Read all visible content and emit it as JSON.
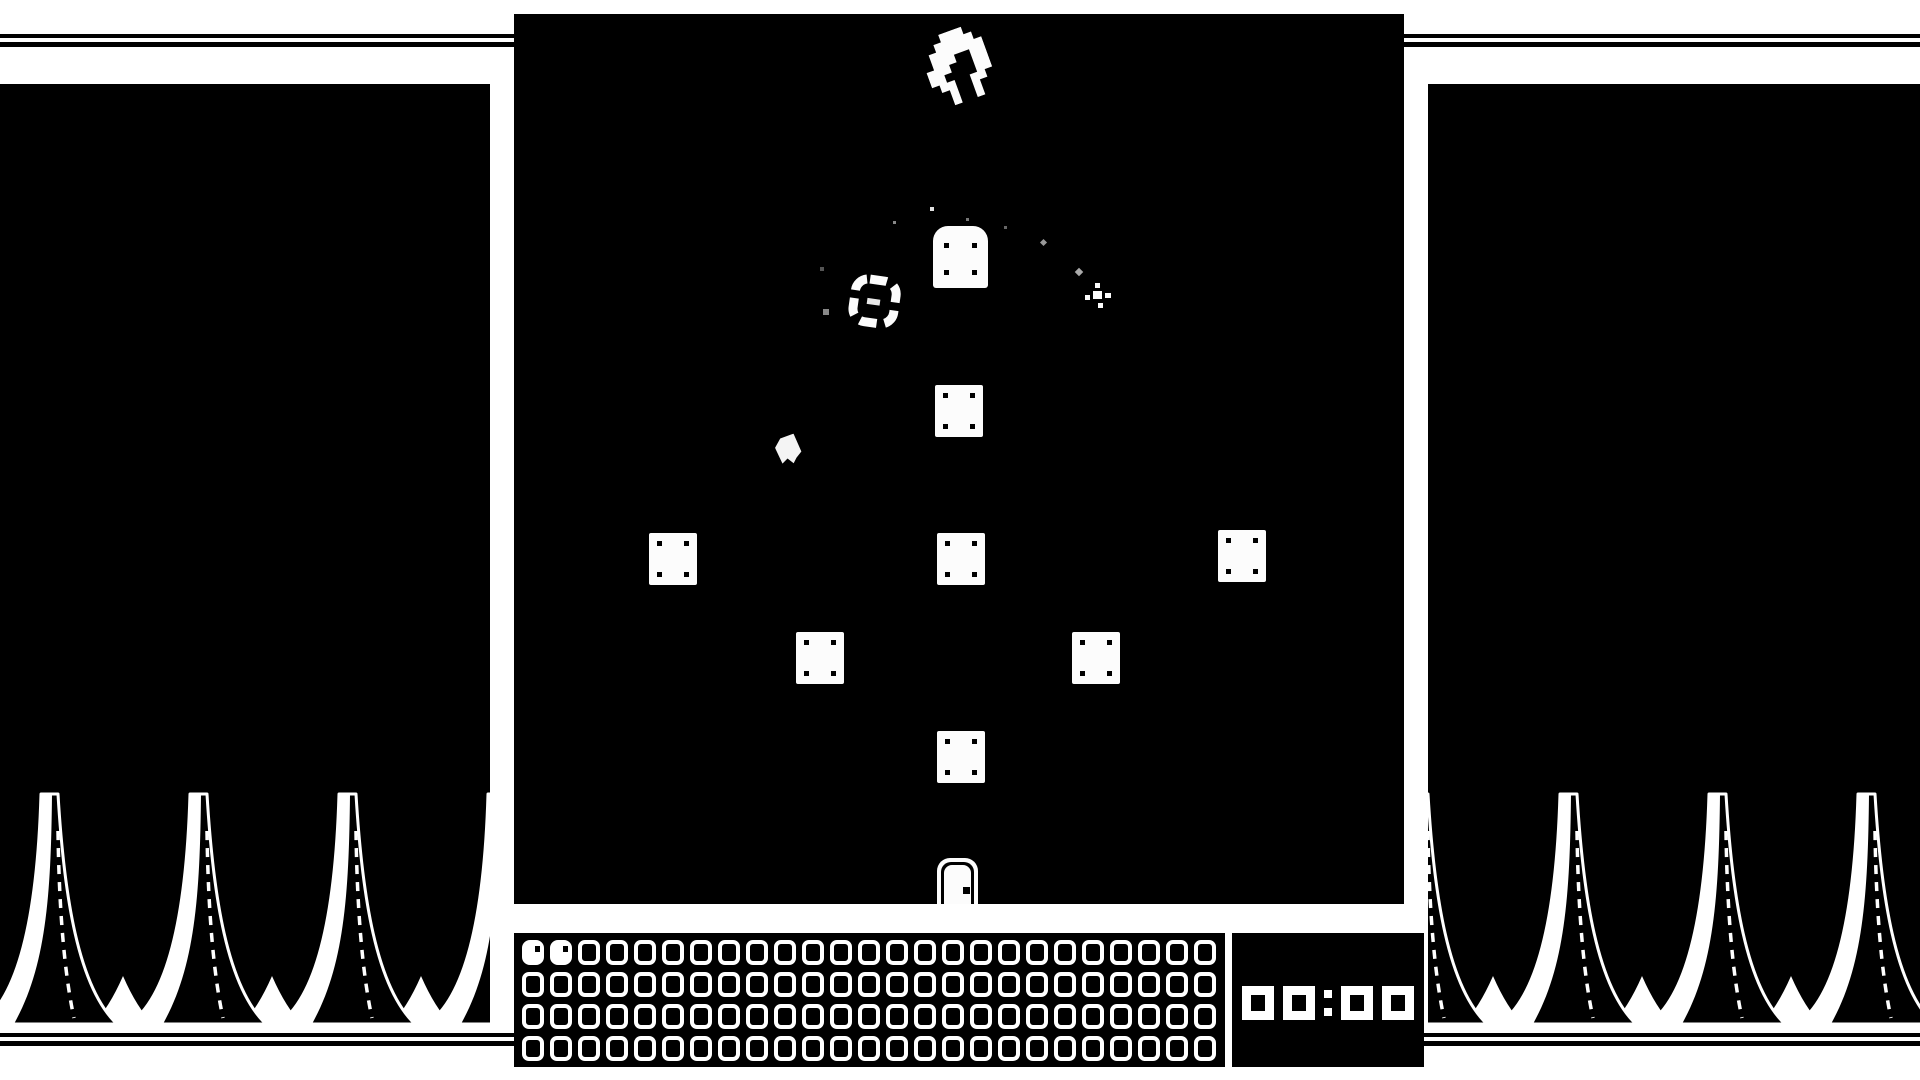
{
  "screen": {
    "background_color": "#ffffff",
    "ink_color": "#000000",
    "style": "1-bit monochrome game"
  },
  "decor": {
    "top_stripe_count": 2,
    "bottom_stripe_count": 2,
    "side_panel_motif": "spiky-mountains-with-dashed-lines"
  },
  "playfield": {
    "sprites": [
      {
        "name": "crab-creature",
        "description": "pixel ring-shaped bug sprite, rotated, top center"
      },
      {
        "name": "gravestone-block",
        "description": "white rounded-top block with four rivets"
      },
      {
        "name": "ring-coin",
        "description": "dashed white ring collectible with center dash"
      },
      {
        "name": "ghost-blob",
        "description": "small tilted white blob"
      },
      {
        "name": "sparkle",
        "description": "small white four-point sparkle"
      },
      {
        "name": "door",
        "description": "white door with black knob at bottom center"
      },
      {
        "name": "plate-block",
        "description": "white square plate with four rivets"
      }
    ],
    "plate_count": 7,
    "debris_particle_count": 8
  },
  "hud": {
    "counter": {
      "columns": 25,
      "rows": 4,
      "total_slots": 100,
      "filled": 2,
      "empty_symbol": "hollow-zero-ring",
      "filled_symbol": "white-head-with-eye"
    },
    "timer": {
      "value": "00:00"
    }
  }
}
